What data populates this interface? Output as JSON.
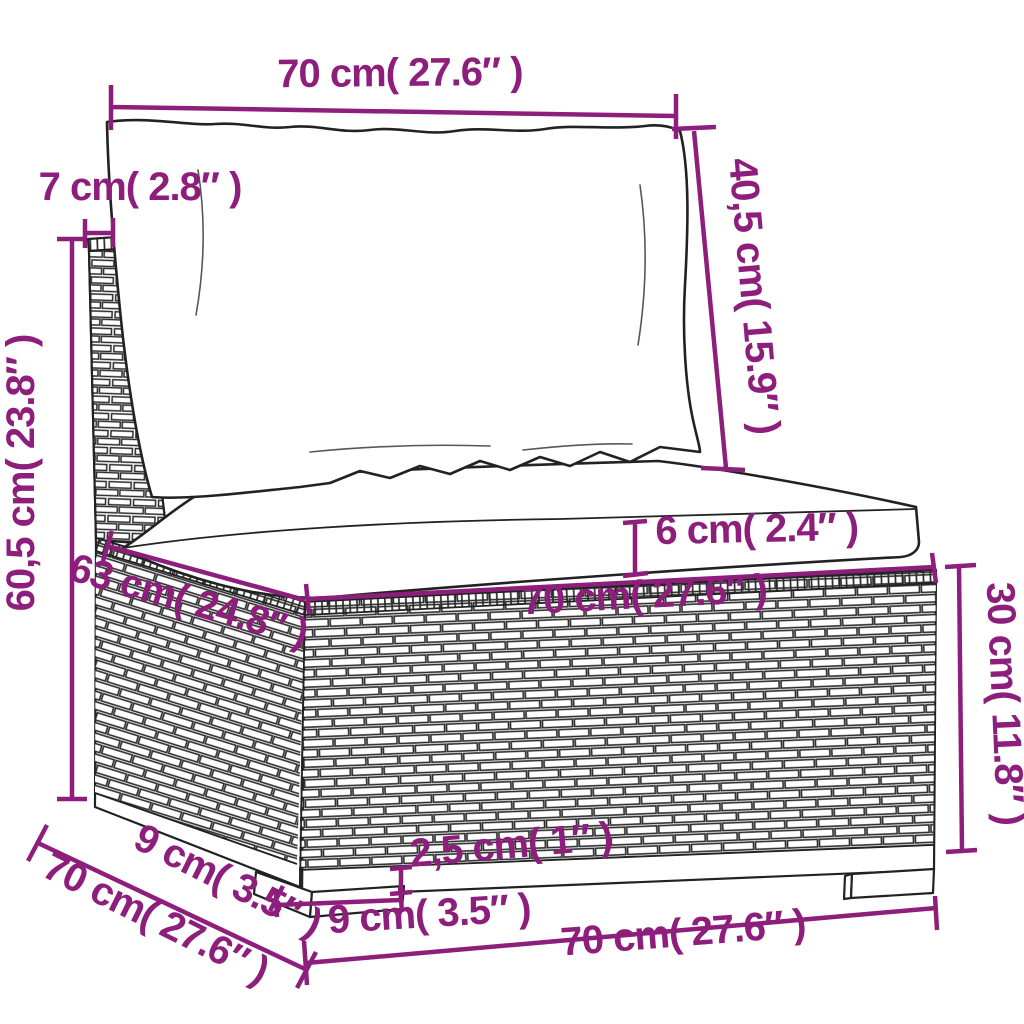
{
  "diagram_title": "rattan-sofa-section-dimension-diagram",
  "colors": {
    "dimension_accent": "#8E1E7C",
    "line_art": "#222222",
    "background": "#FFFFFF"
  },
  "dims": {
    "back_cushion_width": {
      "label": "70 cm( 27.6″ )"
    },
    "back_cushion_height": {
      "label": "40,5 cm( 15.9″ )"
    },
    "backrest_thickness": {
      "label": "7 cm( 2.8″ )"
    },
    "total_height": {
      "label": "60,5 cm( 23.8″ )"
    },
    "seat_cushion_thickness": {
      "label": "6 cm( 2.4″ )"
    },
    "seat_width": {
      "label": "70 cm( 27.6″ )"
    },
    "seat_depth": {
      "label": "63 cm( 24.8″ )"
    },
    "base_height": {
      "label": "30 cm( 11.8″ )"
    },
    "plinth_height": {
      "label": "2,5 cm( 1″ )"
    },
    "leg_width": {
      "label": "9 cm( 3.5″ )"
    },
    "leg_side_depth": {
      "label": "9 cm( 3.5″ )"
    },
    "overall_depth": {
      "label": "70 cm( 27.6″ )"
    },
    "overall_width": {
      "label": "70 cm( 27.6″ )"
    }
  }
}
